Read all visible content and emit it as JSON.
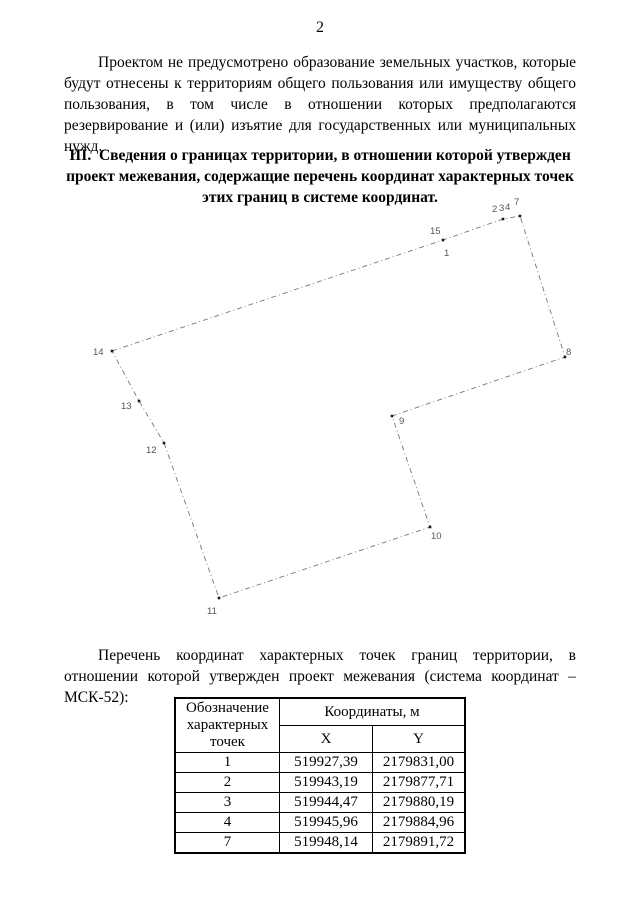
{
  "page_number": "2",
  "intro_paragraph": "Проектом не предусмотрено образование земельных участков, которые будут отнесены к территориям общего пользования или имуществу общего пользования, в том числе в отношении которых предполагаются резервирование и (или) изъятие для государственных или муниципальных нужд.",
  "section_heading": "III. Сведения о границах территории, в отношении которой утвержден проект межевания, содержащие перечень координат характерных точек этих границ в системе координат.",
  "list_paragraph": "Перечень координат характерных точек границ территории, в отношении которой утвержден проект межевания (система координат – МСК-52):",
  "diagram": {
    "type": "boundary-plan",
    "stroke_color": "#777777",
    "point_color": "#1a1a1a",
    "label_color": "#555555",
    "dash_pattern": "5 3 1 3",
    "vertices": [
      {
        "id": "14",
        "x": 112,
        "y": 156
      },
      {
        "id": "15-1",
        "x": 443,
        "y": 45
      },
      {
        "id": "2-3-4",
        "x": 503,
        "y": 24
      },
      {
        "id": "7",
        "x": 520,
        "y": 21
      },
      {
        "id": "8",
        "x": 565,
        "y": 162
      },
      {
        "id": "9",
        "x": 392,
        "y": 221
      },
      {
        "id": "10",
        "x": 430,
        "y": 332
      },
      {
        "id": "11",
        "x": 219,
        "y": 403
      },
      {
        "id": "12",
        "x": 164,
        "y": 248
      },
      {
        "id": "13",
        "x": 139,
        "y": 206
      }
    ],
    "labels": [
      {
        "text": "15",
        "x": 430,
        "y": 39
      },
      {
        "text": "1",
        "x": 444,
        "y": 61
      },
      {
        "text": "2",
        "x": 492,
        "y": 17
      },
      {
        "text": "3",
        "x": 499,
        "y": 16
      },
      {
        "text": "4",
        "x": 505,
        "y": 15
      },
      {
        "text": "7",
        "x": 514,
        "y": 10
      },
      {
        "text": "14",
        "x": 93,
        "y": 160
      },
      {
        "text": "8",
        "x": 566,
        "y": 160
      },
      {
        "text": "13",
        "x": 121,
        "y": 214
      },
      {
        "text": "9",
        "x": 399,
        "y": 229
      },
      {
        "text": "12",
        "x": 146,
        "y": 258
      },
      {
        "text": "10",
        "x": 431,
        "y": 344
      },
      {
        "text": "11",
        "x": 207,
        "y": 419
      }
    ]
  },
  "coords_table": {
    "col_points_header": "Обозначение характерных точек",
    "coords_header": "Координаты, м",
    "x_header": "X",
    "y_header": "Y",
    "rows": [
      {
        "point": "1",
        "x": "519927,39",
        "y": "2179831,00"
      },
      {
        "point": "2",
        "x": "519943,19",
        "y": "2179877,71"
      },
      {
        "point": "3",
        "x": "519944,47",
        "y": "2179880,19"
      },
      {
        "point": "4",
        "x": "519945,96",
        "y": "2179884,96"
      },
      {
        "point": "7",
        "x": "519948,14",
        "y": "2179891,72"
      }
    ]
  }
}
